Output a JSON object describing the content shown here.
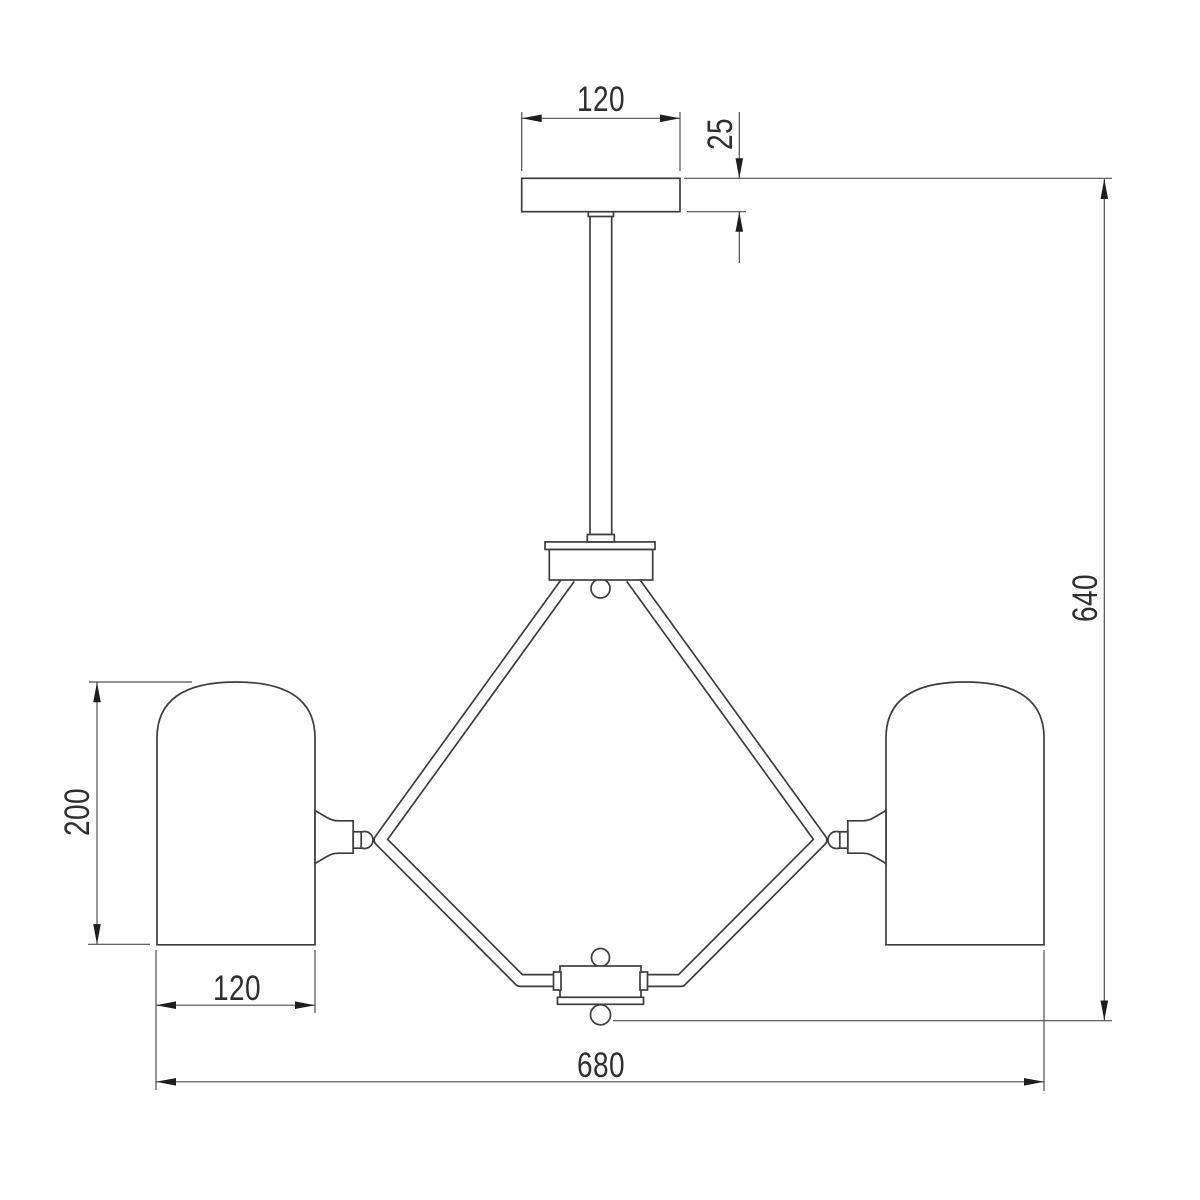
{
  "dimensions": {
    "canopy_width": "120",
    "canopy_height": "25",
    "fixture_height": "640",
    "shade_height": "200",
    "shade_width": "120",
    "fixture_width": "680"
  },
  "colors": {
    "background": "#ffffff",
    "part_outline": "#3d3d3d",
    "dimension_lines": "#4f4f4f",
    "arrowheads": "#1e1e1e",
    "label_text": "#2f2f2f"
  }
}
